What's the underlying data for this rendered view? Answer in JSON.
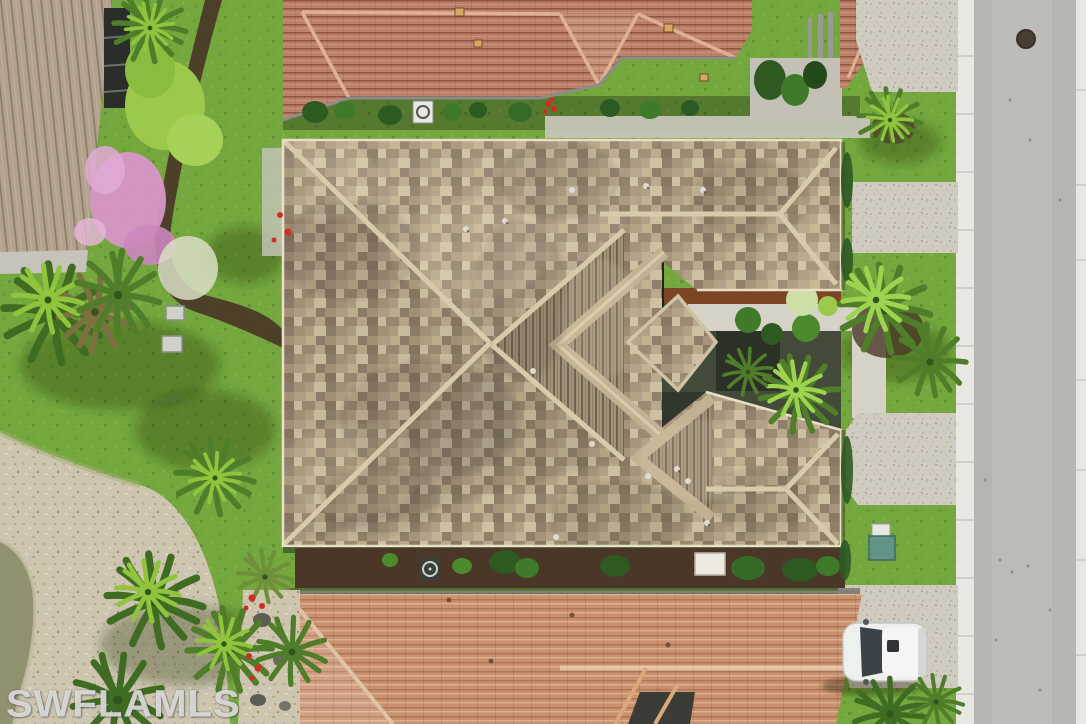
{
  "image": {
    "kind": "aerial-drone-photo",
    "width_px": 1086,
    "height_px": 724,
    "description": "Overhead aerial view of a single-family home with a tan mottled-shingle hip roof and entry courtyard, flanked by terracotta tile-roof neighbors above and below, paver driveways and a gray street along the right, tropical landscaping with palms, a pink flowering tree, sandy scrub and a pond edge at lower left, and a white SUV parked on the lower driveway"
  },
  "watermark": {
    "text": "SWFLAMLS"
  },
  "palette": {
    "grass": "#74a73e",
    "grass_dark": "#558c2c",
    "road": "#b5b6b2",
    "curb": "#e8e7e1",
    "paver": "#d0cbc0",
    "shingle": "#ab9b80",
    "shingle_ridge": "#d8cbab",
    "shingle_stripe": "#6e6253",
    "tile_top_roof": "#bd8169",
    "tile_bottom_roof": "#c9916e",
    "tile_left_roof": "#b2a28d",
    "mulch": "#4a3727",
    "mulch_red": "#7c4526",
    "sand": "#cdc5b0",
    "water": "#90916f",
    "palm_bright": "#8fc43c",
    "palm_dark": "#4e8527",
    "pink_tree": "#d795c8",
    "car_body": "#eef0ee",
    "utility_teal": "#5f9486",
    "flower_red": "#cf2d26",
    "walkway": "#d6d2c8",
    "shadow": "rgba(25,30,18,0.4)"
  },
  "scene": {
    "objects": [
      {
        "name": "main-house-roof",
        "desc": "large tan shingle hip roof with X ridges, striped steep faces and entry pavilion"
      },
      {
        "name": "entry-courtyard",
        "desc": "walkway, red mulch, shrubs and palms cut into right side of main roof"
      },
      {
        "name": "top-neighbor-house",
        "desc": "terracotta tile roof with down-pointing gable, hedge row, AC unit"
      },
      {
        "name": "bottom-neighbor-house",
        "desc": "orange tile roof with left hip and dark inset valley"
      },
      {
        "name": "left-neighbor-house",
        "desc": "tan tile roof corner with dark screened lanai"
      },
      {
        "name": "pink-flowering-tree",
        "desc": "pink blossoming tree upper left"
      },
      {
        "name": "palm-trees",
        "desc": "multiple palms left yard, courtyard and along driveways"
      },
      {
        "name": "lawn",
        "desc": "bright green grass"
      },
      {
        "name": "sandy-scrub",
        "desc": "sandy preserve area lower left"
      },
      {
        "name": "pond",
        "desc": "murky pond edge bottom left corner"
      },
      {
        "name": "street",
        "desc": "gray asphalt road right side with white curbs and manhole"
      },
      {
        "name": "paver-driveways",
        "desc": "speckled paver pads and walkway on right"
      },
      {
        "name": "white-suv",
        "desc": "white SUV parked on lower driveway"
      },
      {
        "name": "utility-boxes",
        "desc": "teal utility box, AC units, equipment pads"
      },
      {
        "name": "watermark",
        "desc": "MLS watermark text lower left"
      }
    ]
  }
}
